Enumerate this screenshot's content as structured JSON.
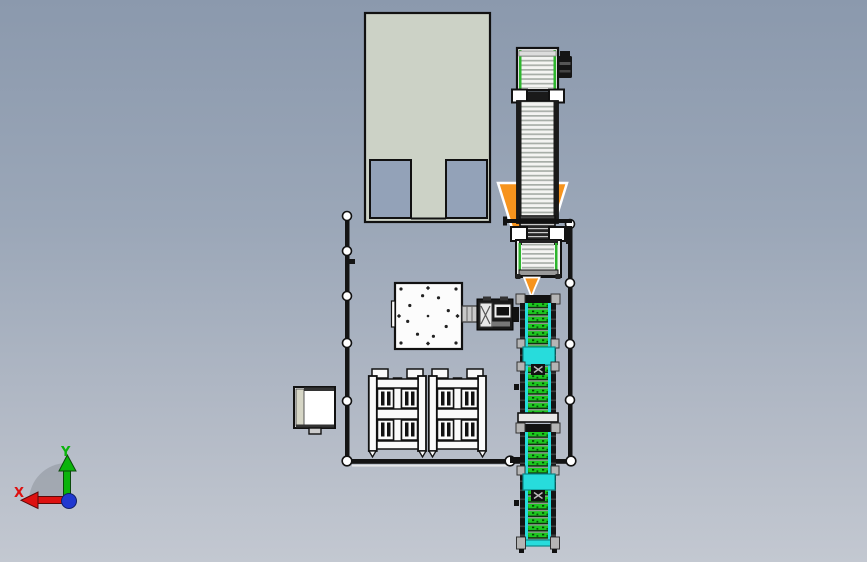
{
  "viewport": {
    "background_top": "#8b99ad",
    "background_bottom": "#c3c8d1"
  },
  "axis_triad": {
    "x_label": "X",
    "y_label": "Y",
    "x_color": "#dd1111",
    "y_color": "#0bb40b",
    "origin_color": "#2038d0"
  },
  "colors": {
    "hopper_fill": "#ccd2c6",
    "hopper_opening": "#93a2b8",
    "accent_orange": "#f7941d",
    "conveyor_cyan": "#27dcdc",
    "conveyor_green": "#1cc91f",
    "frame_black": "#141414",
    "bracket_gray": "#b5b5b5",
    "plate_white": "#fcfcfc",
    "cabinet_strip": "#d6d6c6"
  }
}
